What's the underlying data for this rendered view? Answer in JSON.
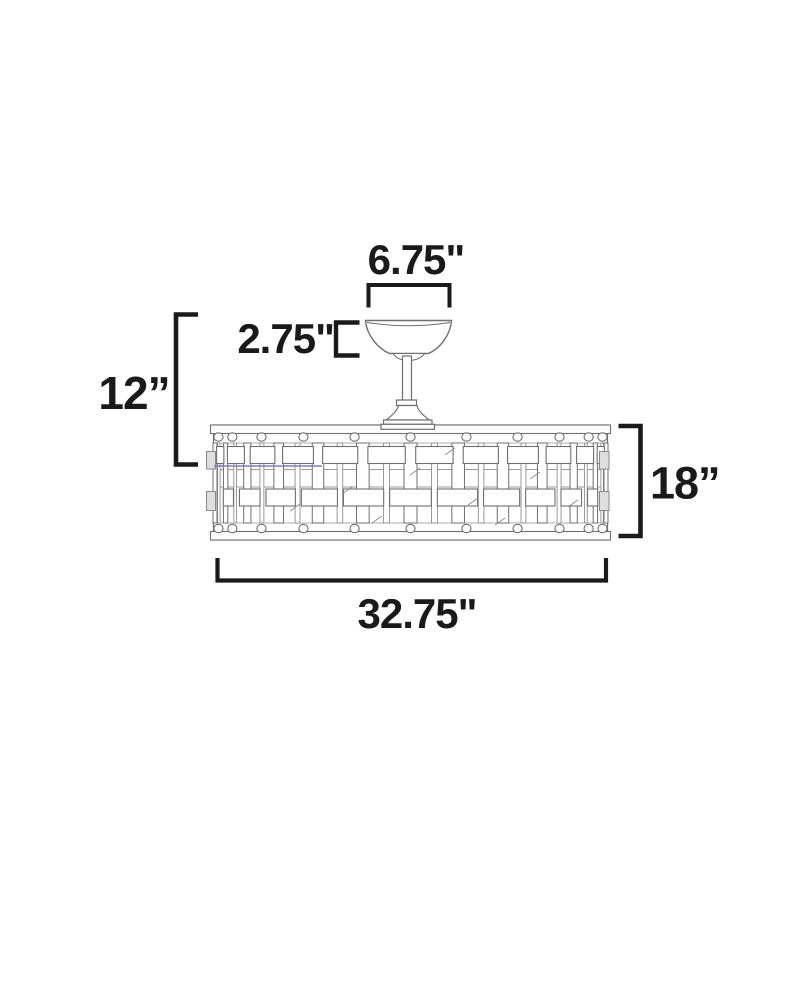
{
  "diagram": {
    "kind": "product-dimension-drawing",
    "dimensions": {
      "canopy_width": "6.75\"",
      "canopy_height": "2.75\"",
      "top_to_blade_height": "12”",
      "drum_height": "18”",
      "drum_width": "32.75\""
    },
    "colors": {
      "line": "#6f6f6f",
      "dimension": "#1a1a1a",
      "blade_level_line": "#7b7bc8",
      "background": "#ffffff"
    }
  }
}
